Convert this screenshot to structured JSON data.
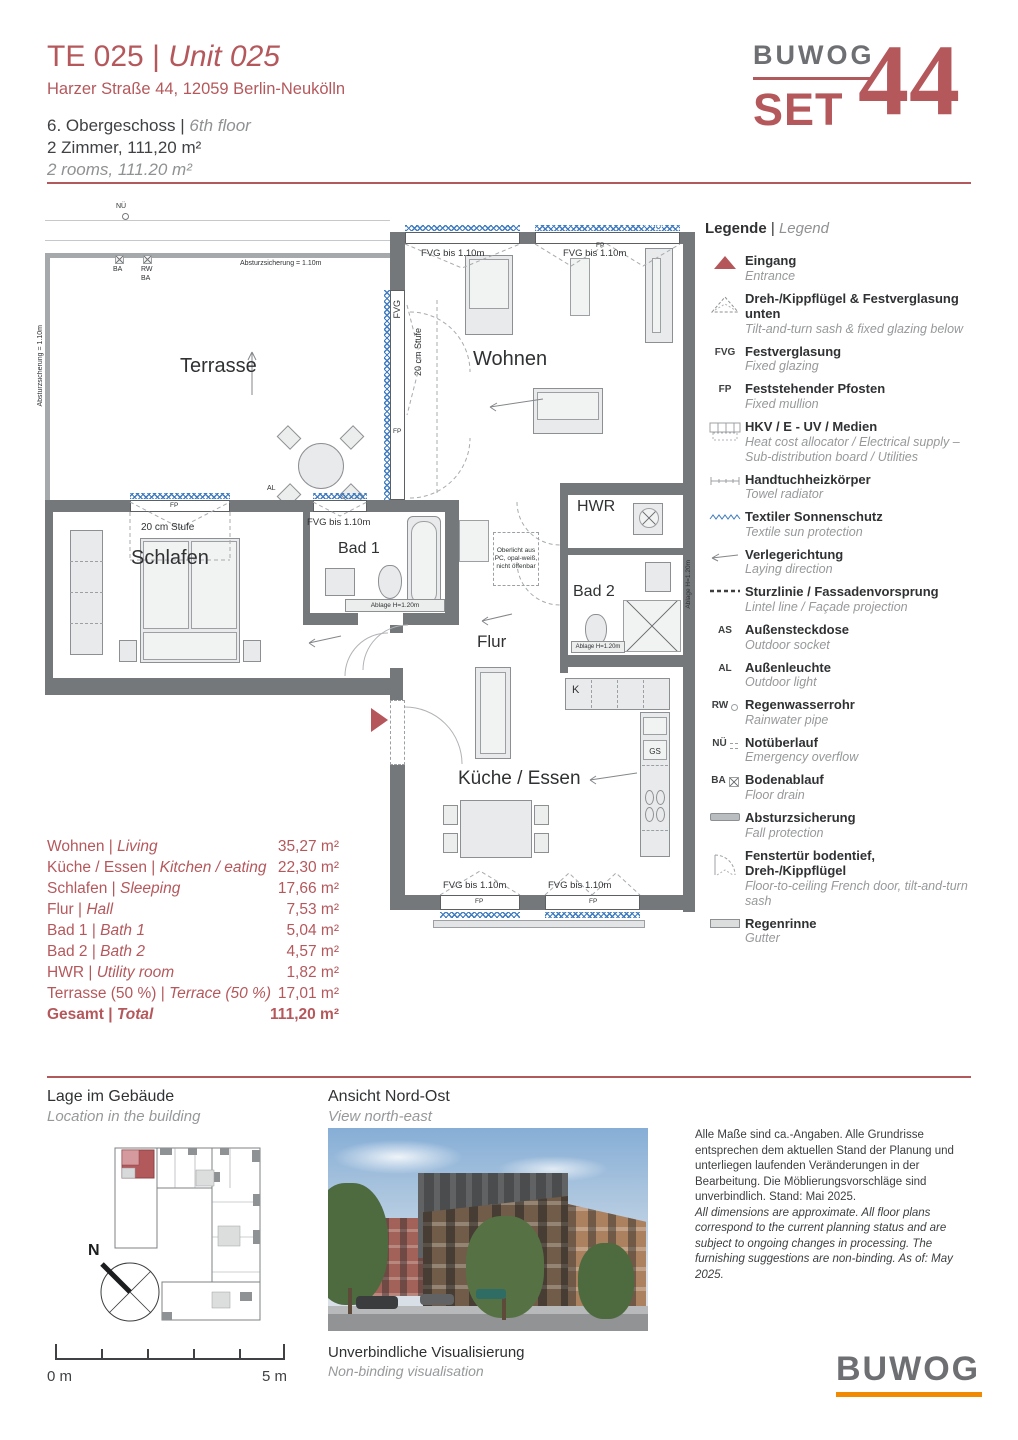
{
  "sep": "|",
  "header": {
    "title_de": "TE 025",
    "title_en": "Unit 025",
    "address": "Harzer Straße 44, 12059 Berlin-Neukölln",
    "floor_de": "6. Obergeschoss",
    "floor_en": "6th floor",
    "rooms_de": "2 Zimmer, 111,20 m²",
    "rooms_en": "2 rooms, 111.20 m²"
  },
  "logo": {
    "brand": "BUWOG",
    "project": "SET",
    "number": "44"
  },
  "plan": {
    "labels": {
      "terrasse": "Terrasse",
      "wohnen": "Wohnen",
      "schlafen": "Schlafen",
      "bad1": "Bad 1",
      "bad2": "Bad 2",
      "hwr": "HWR",
      "flur": "Flur",
      "kueche": "Küche / Essen",
      "fvg_bis": "FVG bis 1.10m",
      "fvg": "FVG",
      "fp": "FP",
      "stufe": "20 cm Stufe",
      "absturz": "Absturzsicherung = 1.10m",
      "ablage": "Ablage H=1.20m",
      "oberlicht": "Oberlicht aus PC, opal-weiß, nicht öffenbar",
      "nue": "NÜ",
      "ba": "BA",
      "rw": "RW",
      "al": "AL",
      "k": "K",
      "gs": "GS"
    }
  },
  "legend": {
    "title_de": "Legende",
    "title_en": "Legend",
    "items": [
      {
        "icon": "entrance",
        "de": "Eingang",
        "en": "Entrance"
      },
      {
        "icon": "tilt-turn-sash",
        "de": "Dreh-/Kippflügel & Festverglasung unten",
        "en": "Tilt-and-turn sash & fixed glazing below"
      },
      {
        "code": "FVG",
        "de": "Festverglasung",
        "en": "Fixed glazing"
      },
      {
        "code": "FP",
        "de": "Feststehender Pfosten",
        "en": "Fixed mullion"
      },
      {
        "icon": "hkv",
        "de": "HKV / E - UV / Medien",
        "en": "Heat cost allocator / Electrical supply – Sub-distribution board / Utilities"
      },
      {
        "icon": "towel-radiator",
        "de": "Handtuchheizkörper",
        "en": "Towel radiator"
      },
      {
        "icon": "sun-protection",
        "de": "Textiler Sonnenschutz",
        "en": "Textile sun protection"
      },
      {
        "icon": "laying-direction",
        "de": "Verlegerichtung",
        "en": "Laying direction"
      },
      {
        "icon": "lintel-line",
        "de": "Sturzlinie / Fassadenvorsprung",
        "en": "Lintel line / Façade projection"
      },
      {
        "code": "AS",
        "de": "Außensteckdose",
        "en": "Outdoor socket"
      },
      {
        "code": "AL",
        "de": "Außenleuchte",
        "en": "Outdoor light"
      },
      {
        "code": "RW",
        "de": "Regenwasserrohr",
        "en": "Rainwater pipe"
      },
      {
        "code": "NÜ",
        "de": "Notüberlauf",
        "en": "Emergency overflow"
      },
      {
        "code": "BA",
        "de": "Bodenablauf",
        "en": "Floor drain"
      },
      {
        "icon": "fall-protection",
        "de": "Absturzsicherung",
        "en": "Fall protection"
      },
      {
        "icon": "french-door",
        "de": "Fenstertür bodentief, Dreh-/Kippflügel",
        "en": "Floor-to-ceiling French door, tilt-and-turn sash"
      },
      {
        "icon": "gutter",
        "de": "Regenrinne",
        "en": "Gutter"
      }
    ]
  },
  "areas": {
    "rows": [
      {
        "de": "Wohnen",
        "en": "Living",
        "value": "35,27 m²"
      },
      {
        "de": "Küche / Essen",
        "en": "Kitchen / eating",
        "value": "22,30 m²"
      },
      {
        "de": "Schlafen",
        "en": "Sleeping",
        "value": "17,66 m²"
      },
      {
        "de": "Flur",
        "en": "Hall",
        "value": "7,53 m²"
      },
      {
        "de": "Bad 1",
        "en": "Bath 1",
        "value": "5,04 m²"
      },
      {
        "de": "Bad 2",
        "en": "Bath 2",
        "value": "4,57 m²"
      },
      {
        "de": "HWR",
        "en": "Utility room",
        "value": "1,82 m²"
      },
      {
        "de": "Terrasse (50 %)",
        "en": "Terrace (50 %)",
        "value": "17,01 m²"
      }
    ],
    "total": {
      "de": "Gesamt",
      "en": "Total",
      "value": "111,20 m²"
    }
  },
  "footer": {
    "location_de": "Lage im Gebäude",
    "location_en": "Location in the building",
    "view_de": "Ansicht Nord-Ost",
    "view_en": "View north-east",
    "visual_de": "Unverbindliche Visualisierung",
    "visual_en": "Non-binding visualisation",
    "disclaimer_de": "Alle Maße sind ca.-Angaben. Alle Grundrisse entsprechen dem aktuellen Stand der Planung und unterliegen laufenden Veränderungen in der Bearbeitung. Die Möblierungsvorschläge sind unverbindlich. Stand: Mai 2025.",
    "disclaimer_en": "All dimensions are approximate. All floor plans correspond to the current planning status and are subject to ongoing changes in processing. The furnishing suggestions are non-binding. As of: May 2025.",
    "scale_start": "0 m",
    "scale_end": "5 m",
    "compass_n": "N",
    "brand": "BUWOG"
  }
}
